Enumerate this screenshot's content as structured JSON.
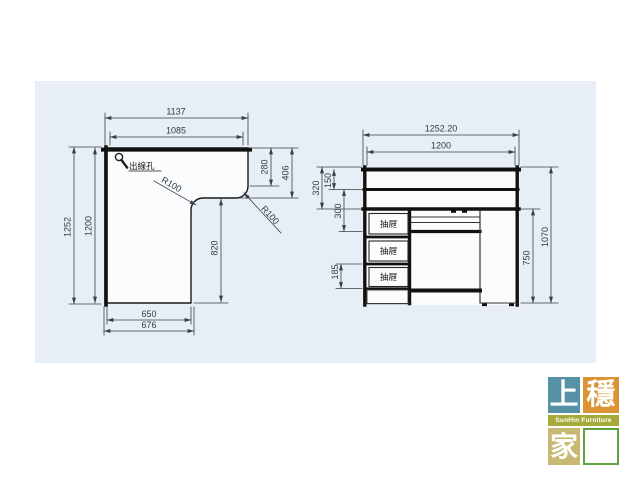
{
  "canvas": {
    "background": "#ffffff",
    "drawing_area_color": "#e7eef5",
    "outline_color": "#1a1a1a",
    "dimension_color": "#3a4047"
  },
  "plan_view": {
    "cable_hole": {
      "label": "出線孔"
    },
    "dims": {
      "width_outer": "1137",
      "width_inner": "1085",
      "right_depth_upper": "280",
      "right_depth_total": "406",
      "corner_radius_left": "R100",
      "corner_radius_right": "R100",
      "inner_edge_length": "820",
      "depth_outer": "1252",
      "depth_inner": "1200",
      "bottom_width_inner": "650",
      "bottom_width_outer": "676"
    }
  },
  "front_view": {
    "drawers": [
      {
        "label": "抽屜"
      },
      {
        "label": "抽屜"
      },
      {
        "label": "抽屜"
      }
    ],
    "dims": {
      "width_outer": "1252.20",
      "width_inner": "1200",
      "hutch_total_height": "320",
      "top_opening_height": "150",
      "upper_section_height": "300",
      "drawer_front_height": "185",
      "under_top_height": "750",
      "total_height": "1070"
    }
  },
  "logo": {
    "top_left_char": "上",
    "top_right_char": "穩",
    "band_text": "SunHin Furniture",
    "bottom_left_char": "家",
    "bottom_right_char": "居",
    "colors": {
      "top_left": "#5691a6",
      "top_right": "#dc9334",
      "band": "#a5aa3a",
      "bottom_left": "#c7b973",
      "bottom_right": "#5ea13e"
    }
  }
}
